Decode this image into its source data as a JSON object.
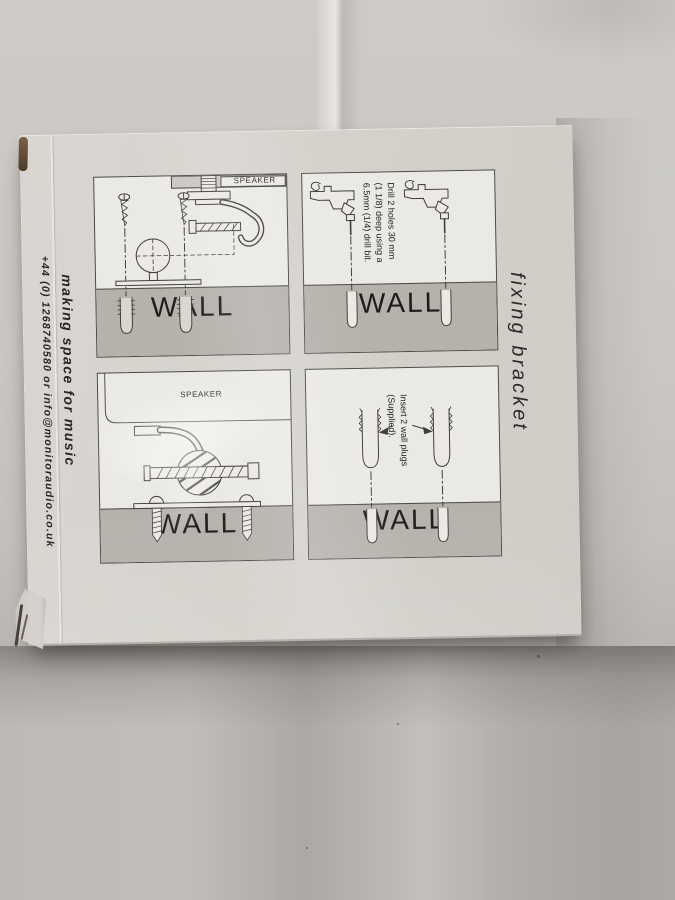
{
  "box_print": {
    "left_side": {
      "tagline": "making space for music",
      "contact": "+44 (0) 1268740580 or info@monitoraudio.co.uk"
    },
    "right_side": {
      "product_label": "fixing bracket"
    },
    "instruction_panels": [
      {
        "name": "bracket-and-fixings-diagram",
        "speaker_label": "SPEAKER",
        "wall_label": "WALL"
      },
      {
        "name": "drill-holes-diagram",
        "wall_label": "WALL",
        "instruction_lines": [
          "Drill 2 holes 30 mm",
          "(1 1/8) deep using a",
          "6.5mm (1/4) drill bit."
        ]
      },
      {
        "name": "speaker-mounted-diagram",
        "speaker_label": "SPEAKER",
        "wall_label": "WALL"
      },
      {
        "name": "insert-wall-plugs-diagram",
        "wall_label": "WALL",
        "instruction_lines": [
          "Insert 2 wall plugs",
          "(Supplied)."
        ]
      }
    ],
    "colors": {
      "fabric": "#c6c2be",
      "box_face": "#d5d2cc",
      "panel_background": "#ebe9e3",
      "wall_grey": "#b5b2ac",
      "line_art": "#3d3d3d",
      "corner_slot_brown": "#6d5741"
    }
  }
}
